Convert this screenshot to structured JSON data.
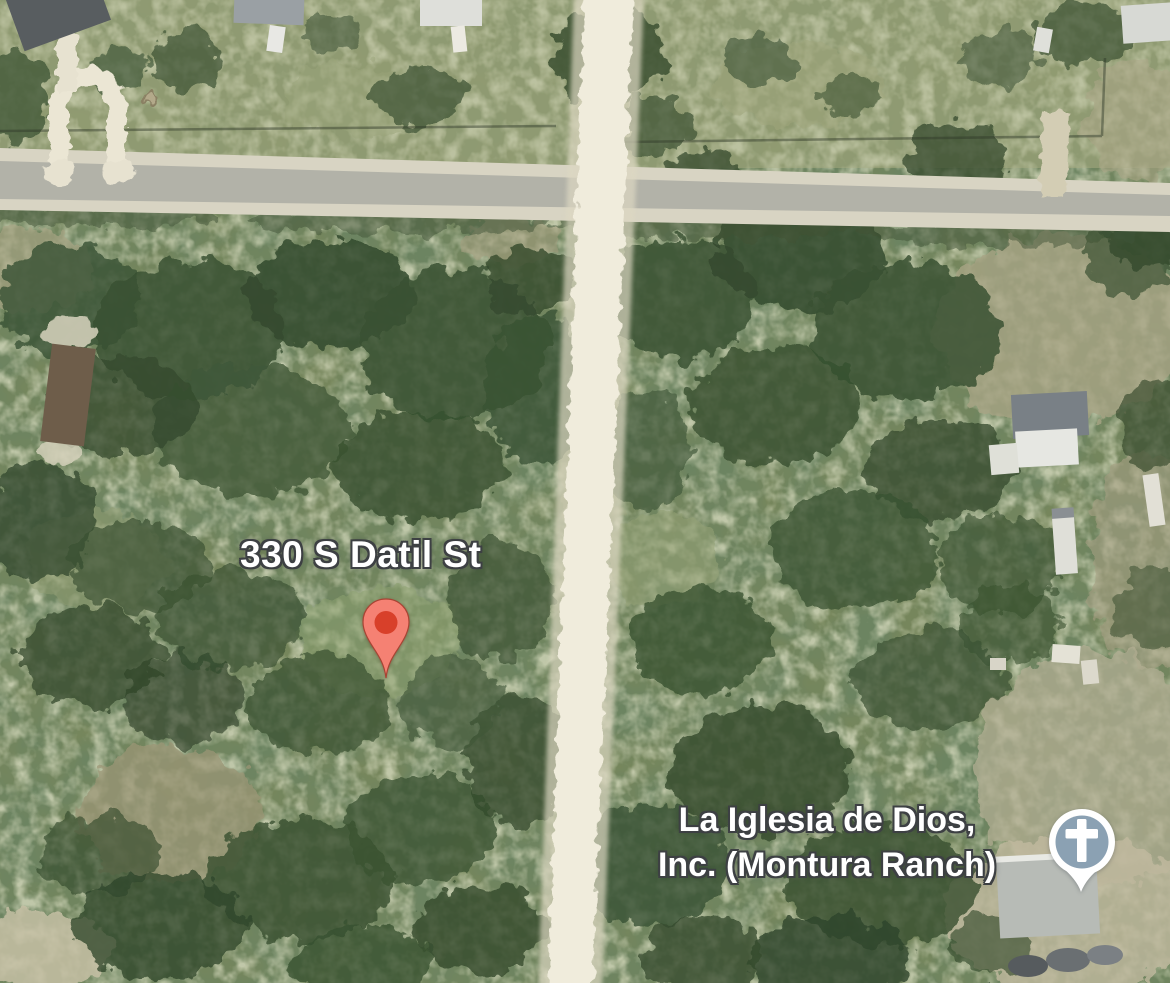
{
  "map": {
    "view_type": "satellite",
    "address_marker": {
      "label": "330 S Datil St",
      "icon": "red-place-pin-icon",
      "pin_color": "#f58173",
      "pin_dot_color": "#d8402a",
      "pin_outline_color": "#a84434"
    },
    "church_poi": {
      "name_line1": "La Iglesia de Dios,",
      "name_line2": "Inc. (Montura Ranch)",
      "icon": "church-cross-icon",
      "icon_circle_color": "#8ba1b3",
      "icon_outline_color": "#ffffff"
    },
    "terrain": {
      "grass_base_color": "#76865c",
      "foliage_dark_color": "#3a5132",
      "paved_road_color": "#b2b2a8",
      "dirt_road_color": "#f0ecdc",
      "clearing_color": "#b2ab8e"
    }
  }
}
